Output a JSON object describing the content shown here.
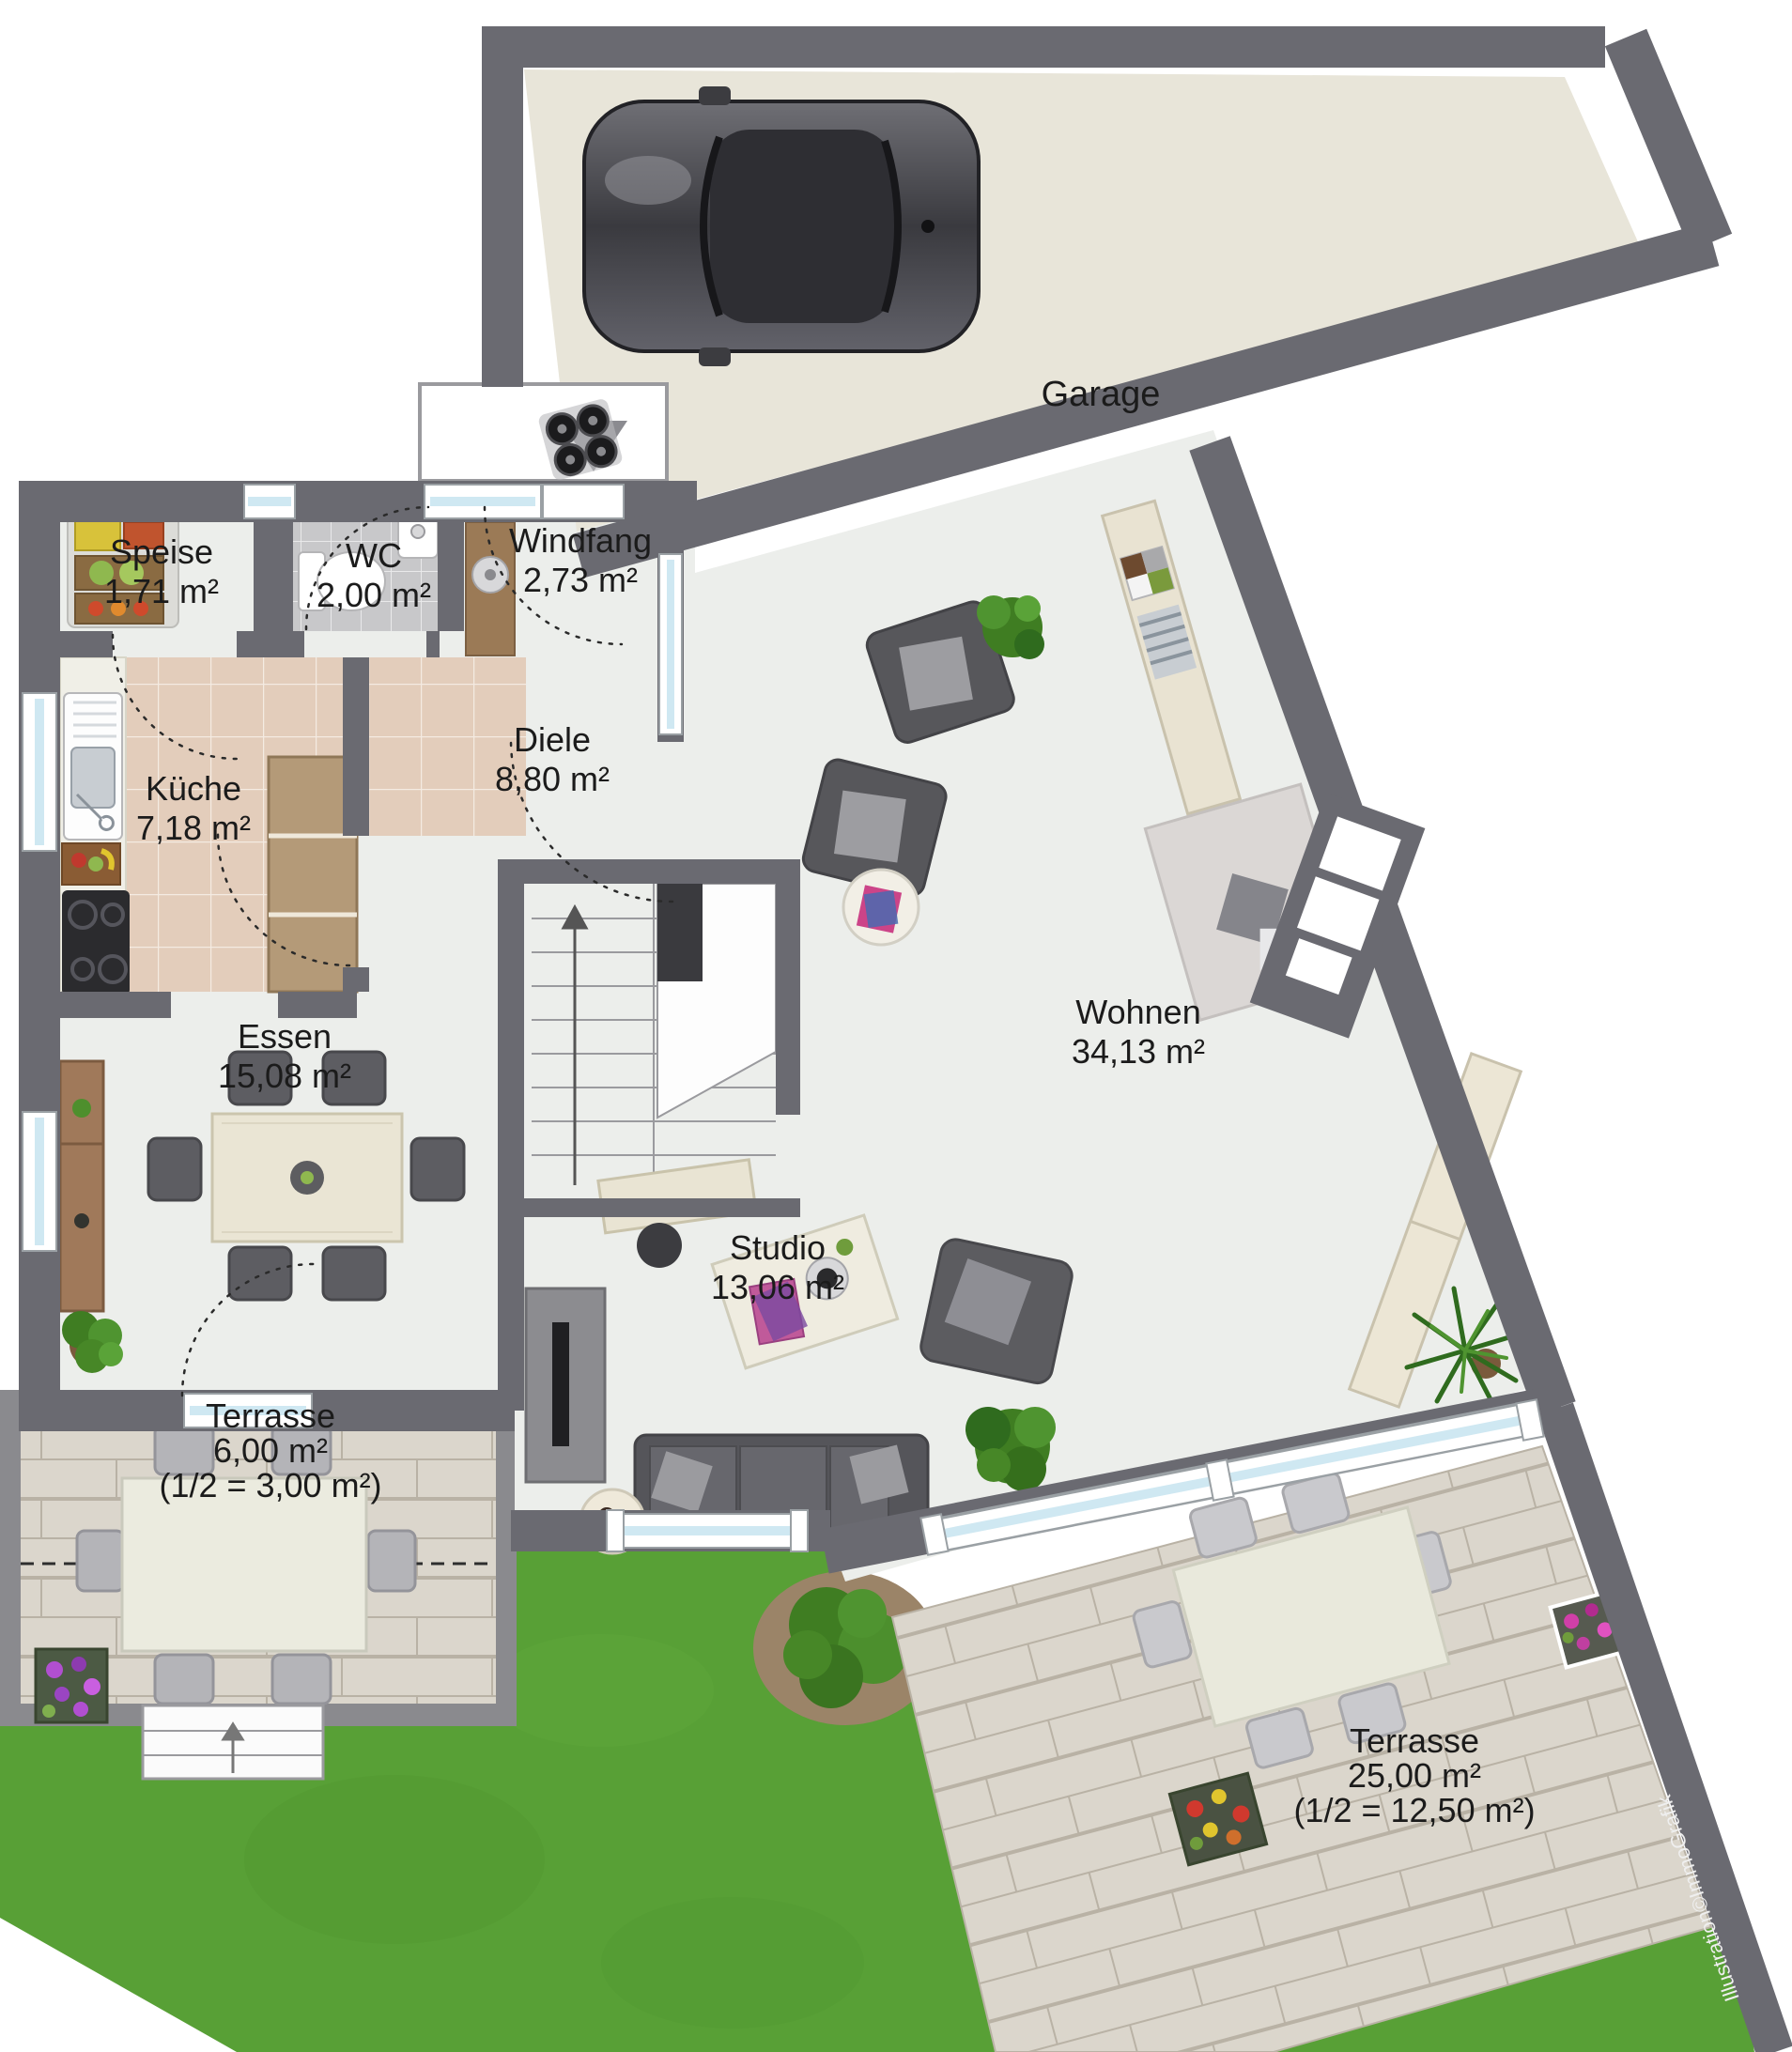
{
  "title": "Erdgeschoss Grundriss",
  "credit": "Illustration©ImmoGrafik",
  "rooms": {
    "garage": {
      "name": "Garage"
    },
    "speise": {
      "name": "Speise",
      "area": "1,71 m²"
    },
    "wc": {
      "name": "WC",
      "area": "2,00 m²"
    },
    "windfang": {
      "name": "Windfang",
      "area": "2,73 m²"
    },
    "diele": {
      "name": "Diele",
      "area": "8,80 m²"
    },
    "kueche": {
      "name": "Küche",
      "area": "7,18 m²"
    },
    "essen": {
      "name": "Essen",
      "area": "15,08 m²"
    },
    "wohnen": {
      "name": "Wohnen",
      "area": "34,13 m²"
    },
    "studio": {
      "name": "Studio",
      "area": "13,06 m²"
    },
    "terrasse_klein": {
      "name": "Terrasse",
      "area": "6,00 m²",
      "half": "(1/2 = 3,00 m²)"
    },
    "terrasse_gross": {
      "name": "Terrasse",
      "area": "25,00 m²",
      "half": "(1/2 = 12,50 m²)"
    }
  },
  "colors": {
    "wall": "#6a6a71",
    "interior_floor": "#eceeeb",
    "garage_floor": "#e8e5d9",
    "kitchen_tile": "#e3cdbb",
    "wc_tile": "#c8c8ca",
    "terrace_paving": "#dbd6cc",
    "grass": "#58a036",
    "window_glass": "#cfe8f2"
  }
}
